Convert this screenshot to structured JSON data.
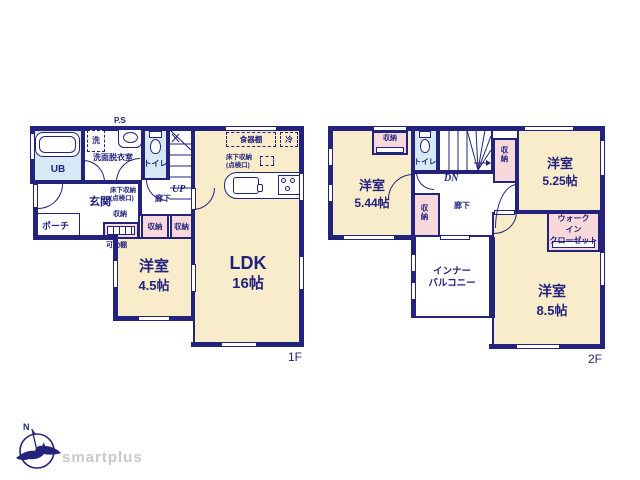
{
  "document_type": "floor-plan",
  "colors": {
    "wall_navy": "#23237e",
    "room_cream": "#f8eccb",
    "closet_pink": "#f8d9db",
    "wet_area_blue": "#d6e9f4",
    "brand_gray": "#c9c9c9"
  },
  "floor1": {
    "label": "1F",
    "ldk": {
      "name": "LDK",
      "size": "16帖"
    },
    "western": {
      "name": "洋室",
      "size": "4.5帖"
    },
    "ub": "UB",
    "washroom": "洗面脱衣室",
    "washer": "洗",
    "ps": "P.S",
    "toilet": "トイレ",
    "up": "UP",
    "hall": "廊下",
    "entrance": "玄関",
    "porch": "ポーチ",
    "storage": "収納",
    "movable_shelf": "可動棚",
    "underfloor": "床下収納\n(点検口)",
    "cupboard": "食器棚",
    "fridge": "冷"
  },
  "floor2": {
    "label": "2F",
    "west544": {
      "name": "洋室",
      "size": "5.44帖"
    },
    "west525": {
      "name": "洋室",
      "size": "5.25帖"
    },
    "west85": {
      "name": "洋室",
      "size": "8.5帖"
    },
    "toilet": "トイレ",
    "dn": "DN",
    "hall": "廊下",
    "storage": "収納",
    "walk_in_closet": "ウォーク\nイン\nクローゼット",
    "inner_balcony": "インナー\nバルコニー"
  },
  "logo": {
    "brand": "smartplus",
    "north": "N"
  }
}
